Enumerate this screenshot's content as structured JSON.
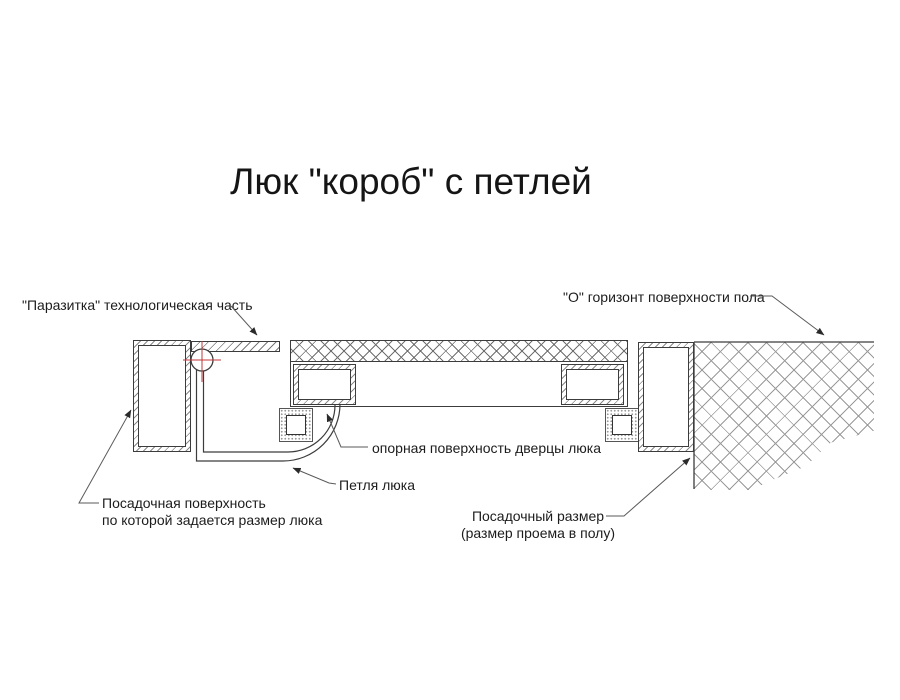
{
  "title": "Люк \"короб\" с петлей",
  "labels": {
    "parasitka": "\"Паразитка\" технологическая часть",
    "floor_horizon": "\"О\" горизонт поверхности пола",
    "door_support_surface": "опорная поверхность дверцы люка",
    "hinge": "Петля люка",
    "seating_surface_line1": "Посадочная поверхность",
    "seating_surface_line2": "по которой задается размер люка",
    "seating_size_line1": "Посадочный размер",
    "seating_size_line2": "(размер проема в полу)"
  },
  "colors": {
    "line": "#3c3c3c",
    "leader": "#5a5a5a",
    "hatch": "#8a8a8a",
    "center_mark_red": "#c23a3a",
    "text": "#1c1c1c",
    "background": "#ffffff"
  }
}
